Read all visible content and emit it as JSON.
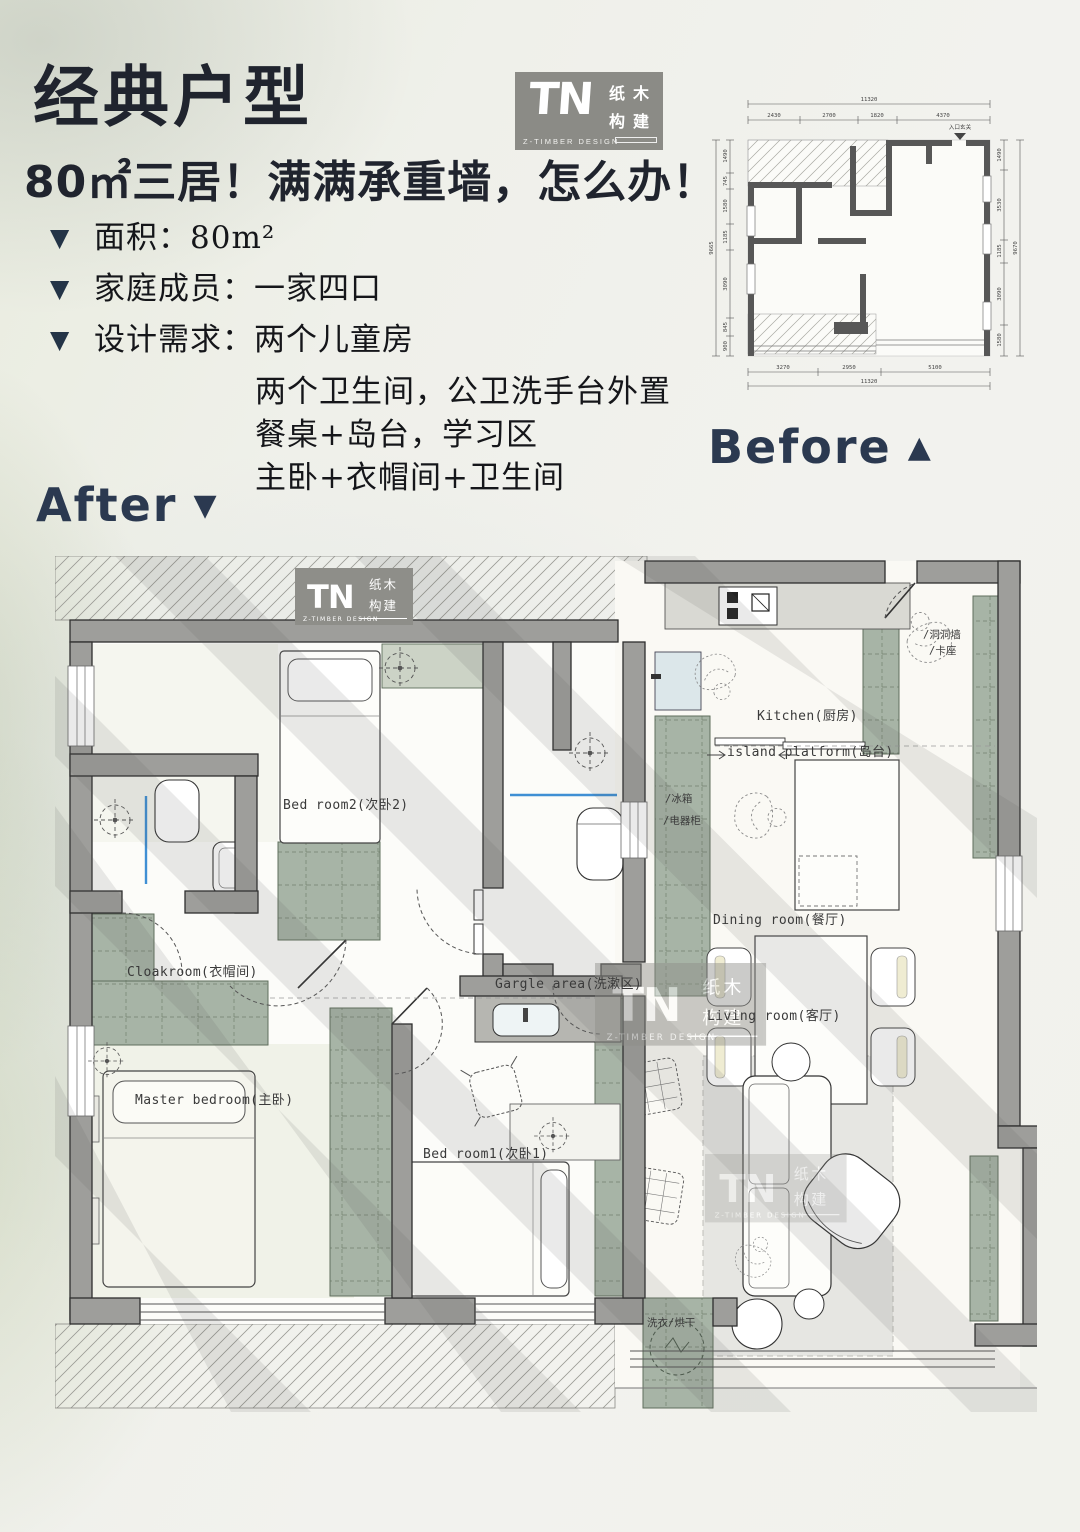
{
  "header": {
    "title": "经典户型",
    "subtitle": "80㎡三居！满满承重墙，怎么办！",
    "bullets": [
      {
        "marker": "▼",
        "label": "面积：",
        "value": "80m²"
      },
      {
        "marker": "▼",
        "label": "家庭成员：",
        "value": "一家四口"
      },
      {
        "marker": "▼",
        "label": "设计需求：",
        "value": "两个儿童房",
        "lines": [
          "两个卫生间，公卫洗手台外置",
          "餐桌+岛台，学习区",
          "主卧+衣帽间+卫生间"
        ]
      }
    ]
  },
  "logo": {
    "mark": "TN",
    "cn_top": "纸木",
    "cn_bottom": "构建",
    "tagline": "Z-TIMBER DESIGN"
  },
  "before": {
    "label": "Before",
    "arrow": "▲",
    "entry": "入口玄关",
    "dims": {
      "top_total": "11320",
      "top": [
        "2430",
        "2700",
        "1820",
        "4370"
      ],
      "bottom": [
        "3270",
        "2950",
        "5100"
      ],
      "bottom_total": "11320",
      "left": [
        "1490",
        "745",
        "1580",
        "1185",
        "3090",
        "845",
        "900"
      ],
      "left_total": "9665",
      "right": [
        "1490",
        "3530",
        "1185",
        "3090",
        "1580"
      ],
      "right_total": "9670"
    }
  },
  "after": {
    "label": "After",
    "arrow": "▼",
    "rooms": {
      "bedroom2": "Bed room2(次卧2)",
      "kitchen": "Kitchen(厨房)",
      "island": "island platform(岛台)",
      "dining": "Dining room(餐厅)",
      "cloakroom": "Cloakroom(衣帽间)",
      "gargle": "Gargle area(洗漱区)",
      "living": "Living room(客厅)",
      "master": "Master bedroom(主卧)",
      "bedroom1": "Bed room1(次卧1)"
    },
    "notes": {
      "pegboard": "/洞洞墙",
      "bench": "/卡座",
      "fridge": "/冰箱",
      "appliance": "/电器柜",
      "laundry": "洗衣/烘干"
    }
  },
  "colors": {
    "accent": "#2b3950",
    "wall": "#9e9e9b",
    "cabinet": "#a7b4a6",
    "before_wall": "#575757",
    "glass_blue": "#3f8fd4"
  }
}
